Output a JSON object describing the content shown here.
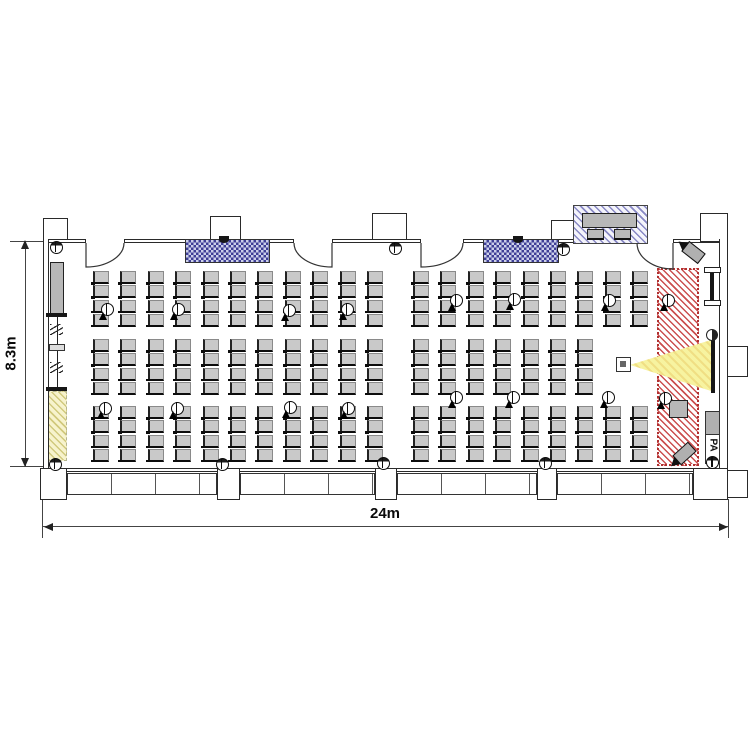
{
  "dimensions": {
    "width_label": "24m",
    "height_label": "8.3m"
  },
  "labels": {
    "pa": "PA"
  },
  "colors": {
    "seat": "#c9c9c9",
    "screen_checker_blue": "#3f3f96",
    "stage_hatch_red": "#b03030",
    "projector_beam_yellow": "#f7f3a0",
    "floor_mat_yellow": "#f7f3cd",
    "wall": "#2a2a2a"
  },
  "seating": {
    "seat_w": 16,
    "seat_h": 13,
    "row_pitch": 14.3,
    "col_pitch": 27.4,
    "bands": [
      {
        "y": 271,
        "rows": 4,
        "sections": [
          {
            "x": 93,
            "cols": 11
          },
          {
            "x": 413,
            "cols": 9
          }
        ]
      },
      {
        "y": 339,
        "rows": 4,
        "sections": [
          {
            "x": 93,
            "cols": 11
          },
          {
            "x": 413,
            "cols": 7
          }
        ]
      },
      {
        "y": 406,
        "rows": 4,
        "sections": [
          {
            "x": 93,
            "cols": 11
          },
          {
            "x": 413,
            "cols": 9
          }
        ]
      }
    ]
  },
  "mics": [
    {
      "x": 107,
      "y": 309
    },
    {
      "x": 178,
      "y": 309
    },
    {
      "x": 289,
      "y": 310
    },
    {
      "x": 347,
      "y": 309
    },
    {
      "x": 456,
      "y": 300
    },
    {
      "x": 514,
      "y": 299
    },
    {
      "x": 609,
      "y": 300
    },
    {
      "x": 105,
      "y": 408
    },
    {
      "x": 177,
      "y": 408
    },
    {
      "x": 290,
      "y": 407
    },
    {
      "x": 348,
      "y": 408
    },
    {
      "x": 456,
      "y": 397
    },
    {
      "x": 513,
      "y": 397
    },
    {
      "x": 608,
      "y": 397
    },
    {
      "x": 668,
      "y": 300
    },
    {
      "x": 665,
      "y": 398
    }
  ],
  "wall_lights": [
    {
      "x": 56,
      "y": 247
    },
    {
      "x": 395,
      "y": 248
    },
    {
      "x": 563,
      "y": 249
    },
    {
      "x": 55,
      "y": 464
    },
    {
      "x": 222,
      "y": 464
    },
    {
      "x": 383,
      "y": 463
    },
    {
      "x": 545,
      "y": 463
    }
  ]
}
